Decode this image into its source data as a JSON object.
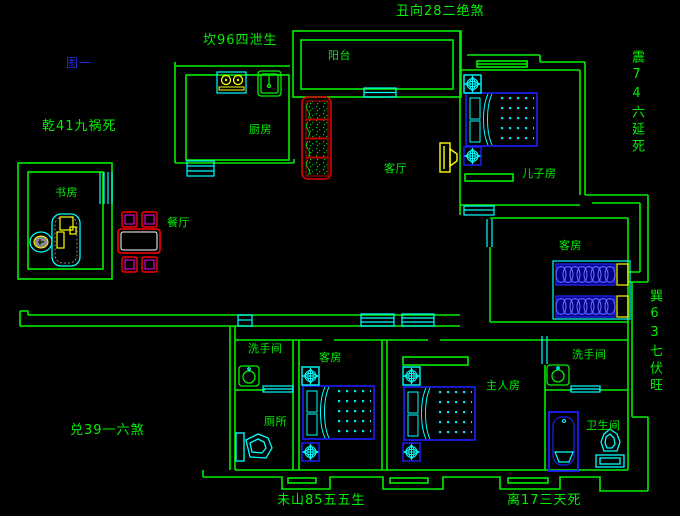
{
  "figure": {
    "caption": "图一"
  },
  "annotations": {
    "chou": "丑向28二绝煞",
    "kan": "坎96四泄生",
    "qian": "乾41九祸死",
    "zhen": "震74六延死",
    "xun": "巽63七伏旺",
    "dui": "兑39一六煞",
    "wei": "未山85五五生",
    "li": "离17三天死"
  },
  "rooms": {
    "balcony": "阳台",
    "kitchen": "厨房",
    "living": "客厅",
    "son_room": "儿子房",
    "study": "书房",
    "dining": "餐厅",
    "guest_upper": "客房",
    "guest_lower": "客房",
    "washroom_left": "洗手间",
    "washroom_right": "洗手间",
    "toilet": "厕所",
    "master": "主人房",
    "bathroom": "卫生间"
  },
  "colors": {
    "background": "#000000",
    "wall_green": "#00F000",
    "fixture_cyan": "#00FFFF",
    "bed_blue": "#1E1EFF",
    "accent_yellow": "#FFFF00",
    "sofa_table_red": "#FF0000",
    "chair_magenta": "#FF00FF",
    "figure_label_blue": "#2828DC"
  }
}
